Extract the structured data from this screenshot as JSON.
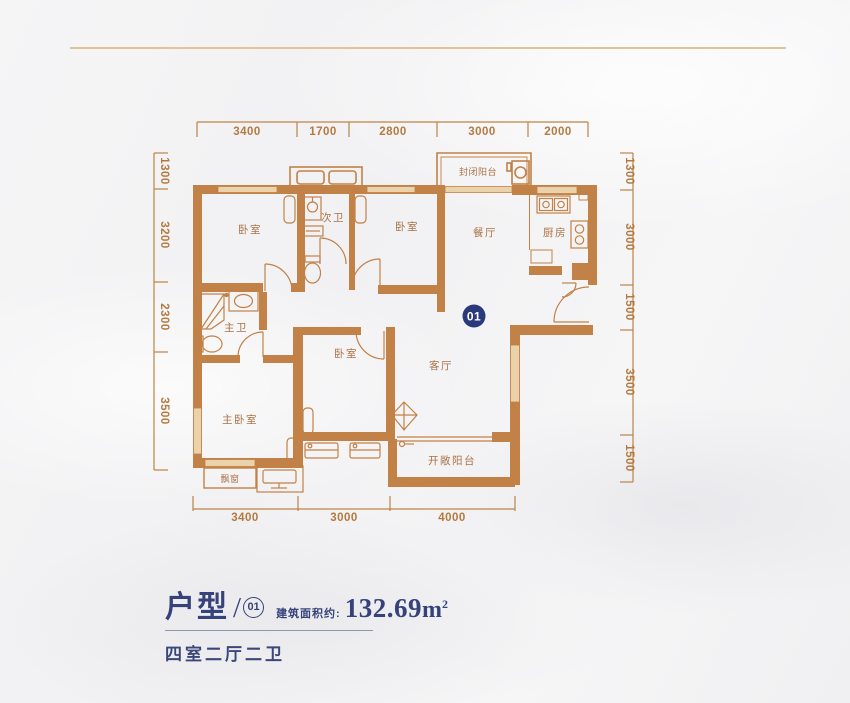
{
  "page": {
    "background": "#f3f3f4",
    "top_rule_color": "#dcc49c"
  },
  "plan": {
    "wall_color": "#c28146",
    "window_color": "#ead2ab",
    "line_color": "#bd8347",
    "badge": {
      "label": "01",
      "color": "#2a397c"
    },
    "rooms": [
      {
        "id": "bedroom-top-left",
        "label": "卧室"
      },
      {
        "id": "second-bathroom",
        "label": "次卫"
      },
      {
        "id": "bedroom-top-mid",
        "label": "卧室"
      },
      {
        "id": "dining-room",
        "label": "餐厅"
      },
      {
        "id": "kitchen",
        "label": "厨房"
      },
      {
        "id": "enclosed-balcony",
        "label": "封闭阳台"
      },
      {
        "id": "master-bathroom",
        "label": "主卫"
      },
      {
        "id": "bedroom-mid",
        "label": "卧室"
      },
      {
        "id": "living-room",
        "label": "客厅"
      },
      {
        "id": "master-bedroom",
        "label": "主卧室"
      },
      {
        "id": "bay-window",
        "label": "飘窗"
      },
      {
        "id": "open-balcony",
        "label": "开敞阳台"
      }
    ],
    "dimensions": {
      "top": [
        "3400",
        "1700",
        "2800",
        "3000",
        "2000"
      ],
      "left": [
        "1300",
        "3200",
        "2300",
        "3500"
      ],
      "right": [
        "1300",
        "3000",
        "1500",
        "3500",
        "1500"
      ],
      "bottom": [
        "3400",
        "3000",
        "4000"
      ]
    }
  },
  "info": {
    "type_label": "户型",
    "slash": "/",
    "unit_number": "01",
    "area_label": "建筑面积约:",
    "area_value": "132.69",
    "area_unit": "m",
    "area_sup": "2",
    "layout_desc": "四室二厅二卫"
  }
}
